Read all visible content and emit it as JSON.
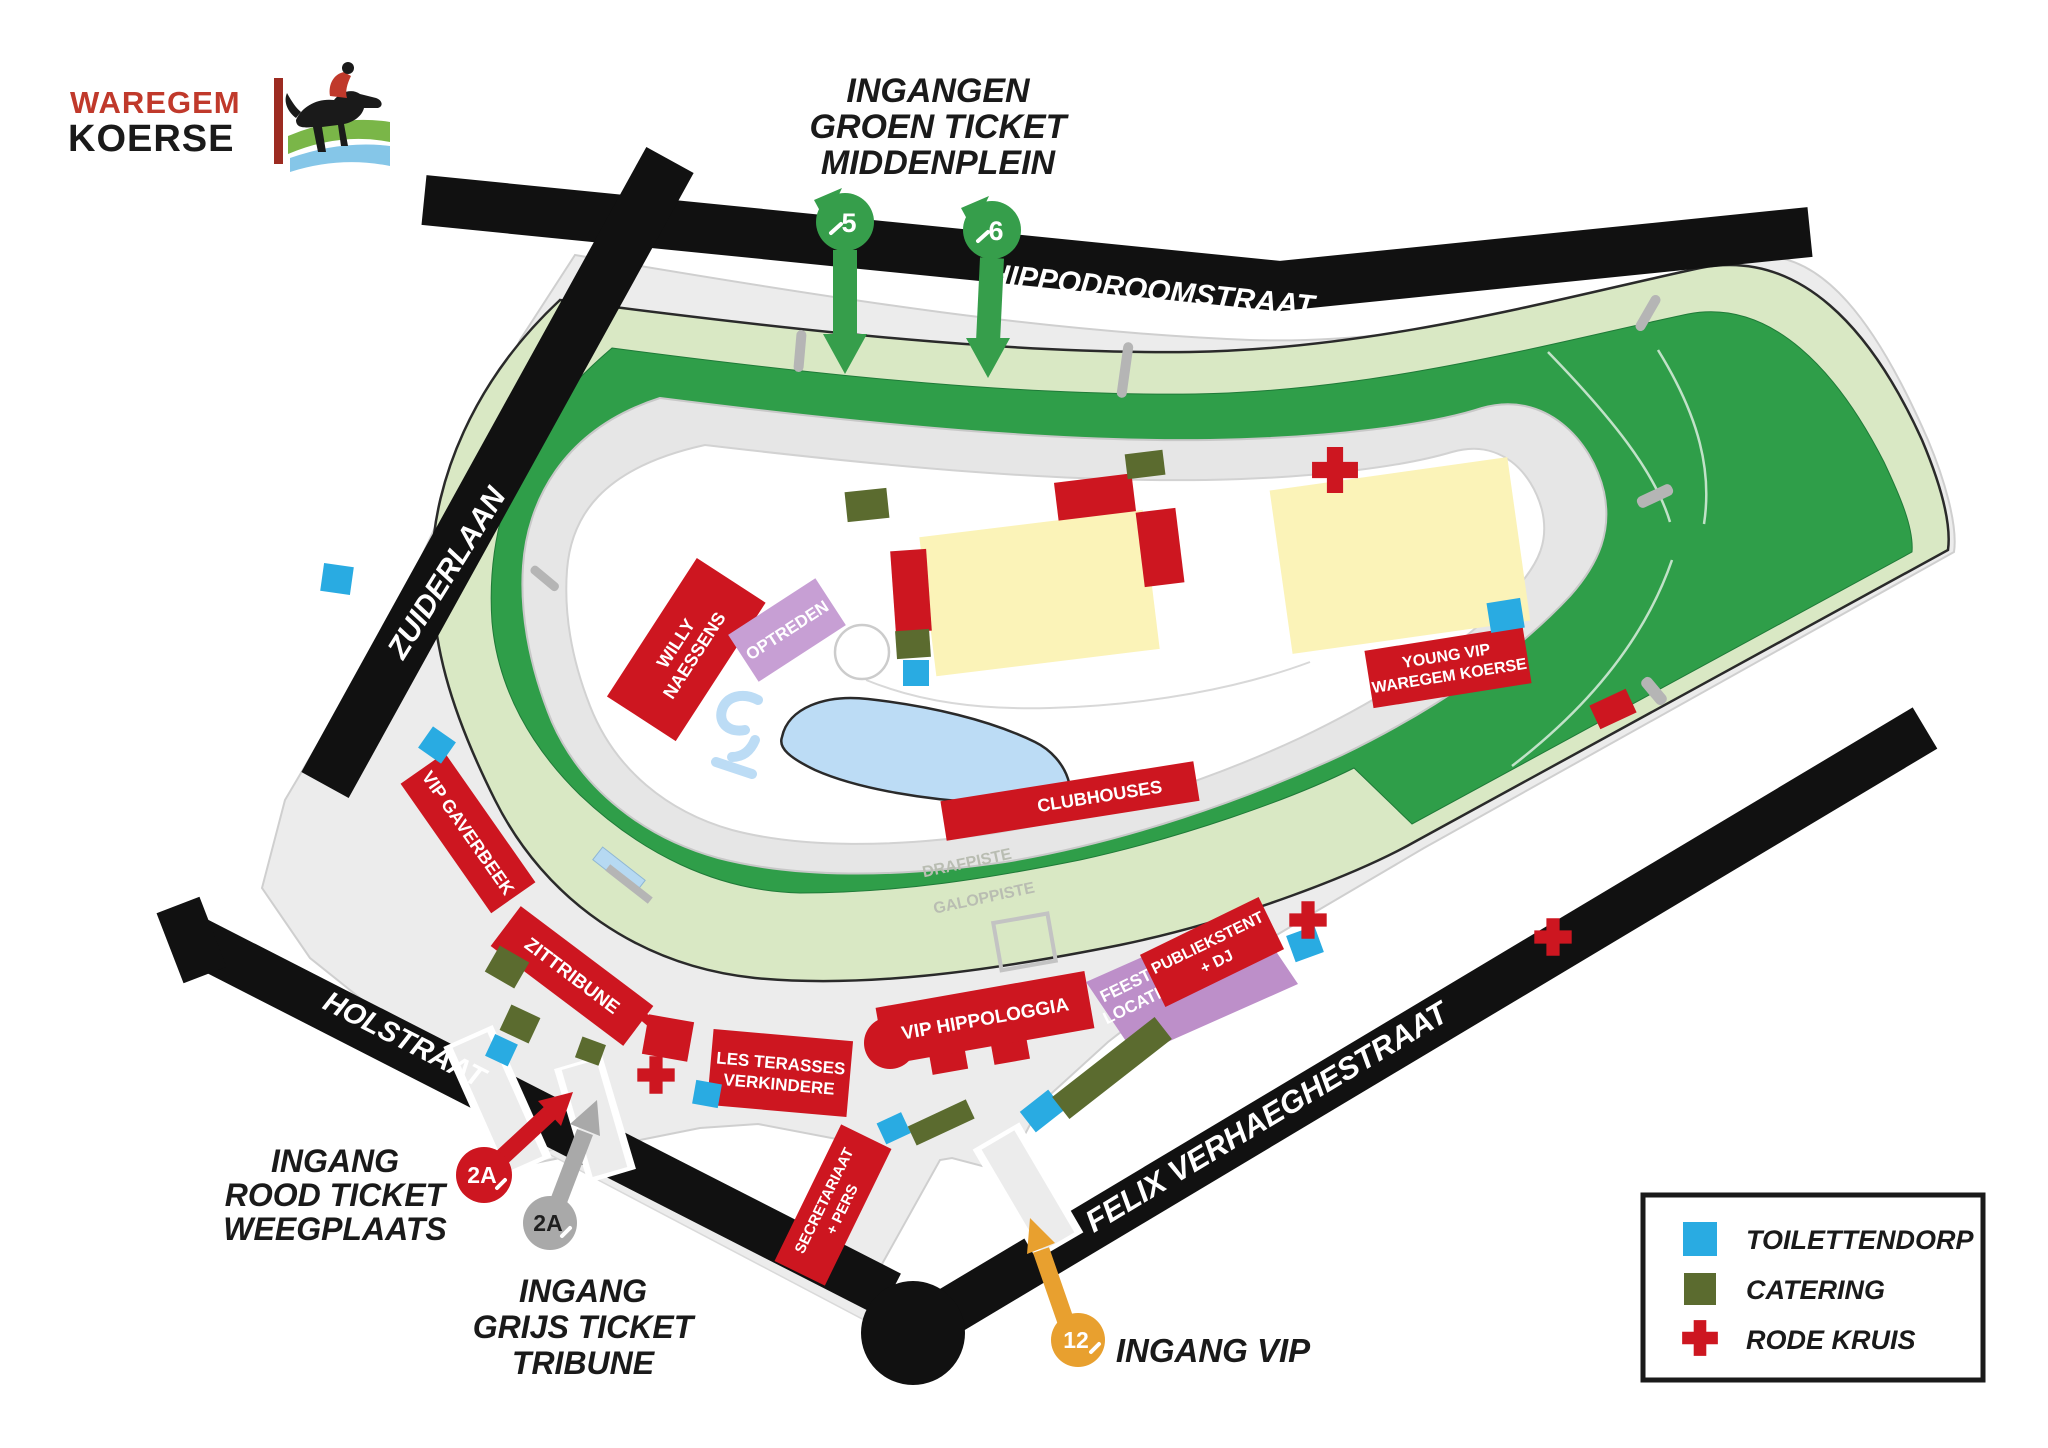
{
  "logo": {
    "word_top": "WAREGEM",
    "word_bottom": "KOERSE"
  },
  "green_entrances": {
    "line1": "INGANGEN",
    "line2": "GROEN TICKET",
    "line3": "MIDDENPLEIN",
    "marker_5": "5",
    "marker_6": "6"
  },
  "streets": {
    "north": "HIPPODROOMSTRAAT",
    "west": "ZUIDERLAAN",
    "southwest": "HOLSTRAAT",
    "southeast": "FELIX VERHAEGHESTRAAT"
  },
  "track": {
    "outer_label": "GALOPPISTE",
    "inner_label": "DRAFPISTE"
  },
  "venues": {
    "willy_line1": "WILLY",
    "willy_line2": "NAESSENS",
    "optreden": "OPTREDEN",
    "clubhouses": "CLUBHOUSES",
    "young_vip_line1": "YOUNG VIP",
    "young_vip_line2": "WAREGEM KOERSE",
    "vip_gaverbeek": "VIP GAVERBEEK",
    "zittribune": "ZITTRIBUNE",
    "les_terasses_line1": "LES TERASSES",
    "les_terasses_line2": "VERKINDERE",
    "vip_hippologgia": "VIP HIPPOLOGGIA",
    "feest_line1": "FEEST-",
    "feest_line2": "LOCATIE",
    "publiekstent_line1": "PUBLIEKSTENT",
    "publiekstent_line2": "+  DJ",
    "secretariaat_line1": "SECRETARIAAT",
    "secretariaat_line2": "+ PERS"
  },
  "entrances": {
    "rood_marker": "2A",
    "rood_line1": "INGANG",
    "rood_line2": "ROOD TICKET",
    "rood_line3": "WEEGPLAATS",
    "grijs_marker": "2A",
    "grijs_line1": "INGANG",
    "grijs_line2": "GRIJS TICKET",
    "grijs_line3": "TRIBUNE",
    "vip_marker": "12",
    "vip_label": "INGANG VIP"
  },
  "legend": {
    "toilettendorp": "TOILETTENDORP",
    "catering": "CATERING",
    "rode_kruis": "RODE KRUIS"
  },
  "colors": {
    "track_green": "#2f9e49",
    "track_light_green": "#d9e8c4",
    "red": "#cd1620",
    "toilet_blue": "#29abe2",
    "catering_olive": "#5b6b2f",
    "vip_orange": "#e8a02f",
    "grey_marker": "#a9a9a9",
    "purple_light": "#c79fd4",
    "purple": "#bd8fc9",
    "building_yellow": "#fbf3b8",
    "street_black": "#111111"
  }
}
